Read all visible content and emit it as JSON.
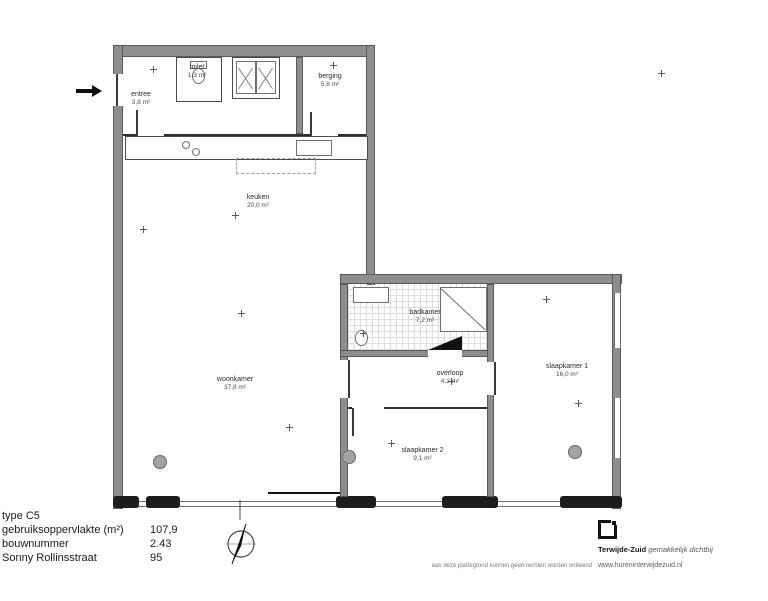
{
  "title_block": {
    "type_row": "type C5",
    "rows": [
      {
        "label": "gebruiksoppervlakte (m²)",
        "value": "107,9"
      },
      {
        "label": "bouwnummer",
        "value": "2.43"
      },
      {
        "label": "Sonny Rollinsstraat",
        "value": "95"
      }
    ]
  },
  "rooms": {
    "entree": {
      "name": "entree",
      "area": "3,8 m²"
    },
    "toilet": {
      "name": "toilet",
      "area": "1,3 m²"
    },
    "berging": {
      "name": "berging",
      "area": "5,8 m²"
    },
    "keuken": {
      "name": "keuken",
      "area": "20,0 m²"
    },
    "woonkamer": {
      "name": "woonkamer",
      "area": "37,8 m²"
    },
    "badkamer": {
      "name": "badkamer",
      "area": "7,2 m²"
    },
    "overloop": {
      "name": "overloop",
      "area": "4,2 m²"
    },
    "slaapkamer1": {
      "name": "slaapkamer 1",
      "area": "16,0 m²"
    },
    "slaapkamer2": {
      "name": "slaapkamer 2",
      "area": "9,1 m²"
    }
  },
  "branding": {
    "name": "Terwijde-Zuid",
    "tagline": "gemakkelijk dichtbij",
    "url": "www.hureninterwijdezuid.nl"
  },
  "disclaimer": "aan deze plattegrond kunnen geen rechten worden ontleend",
  "colors": {
    "wall_fill": "#8e8e8e",
    "wall_edge": "#5a5a5a",
    "pier": "#1d1d1d"
  }
}
